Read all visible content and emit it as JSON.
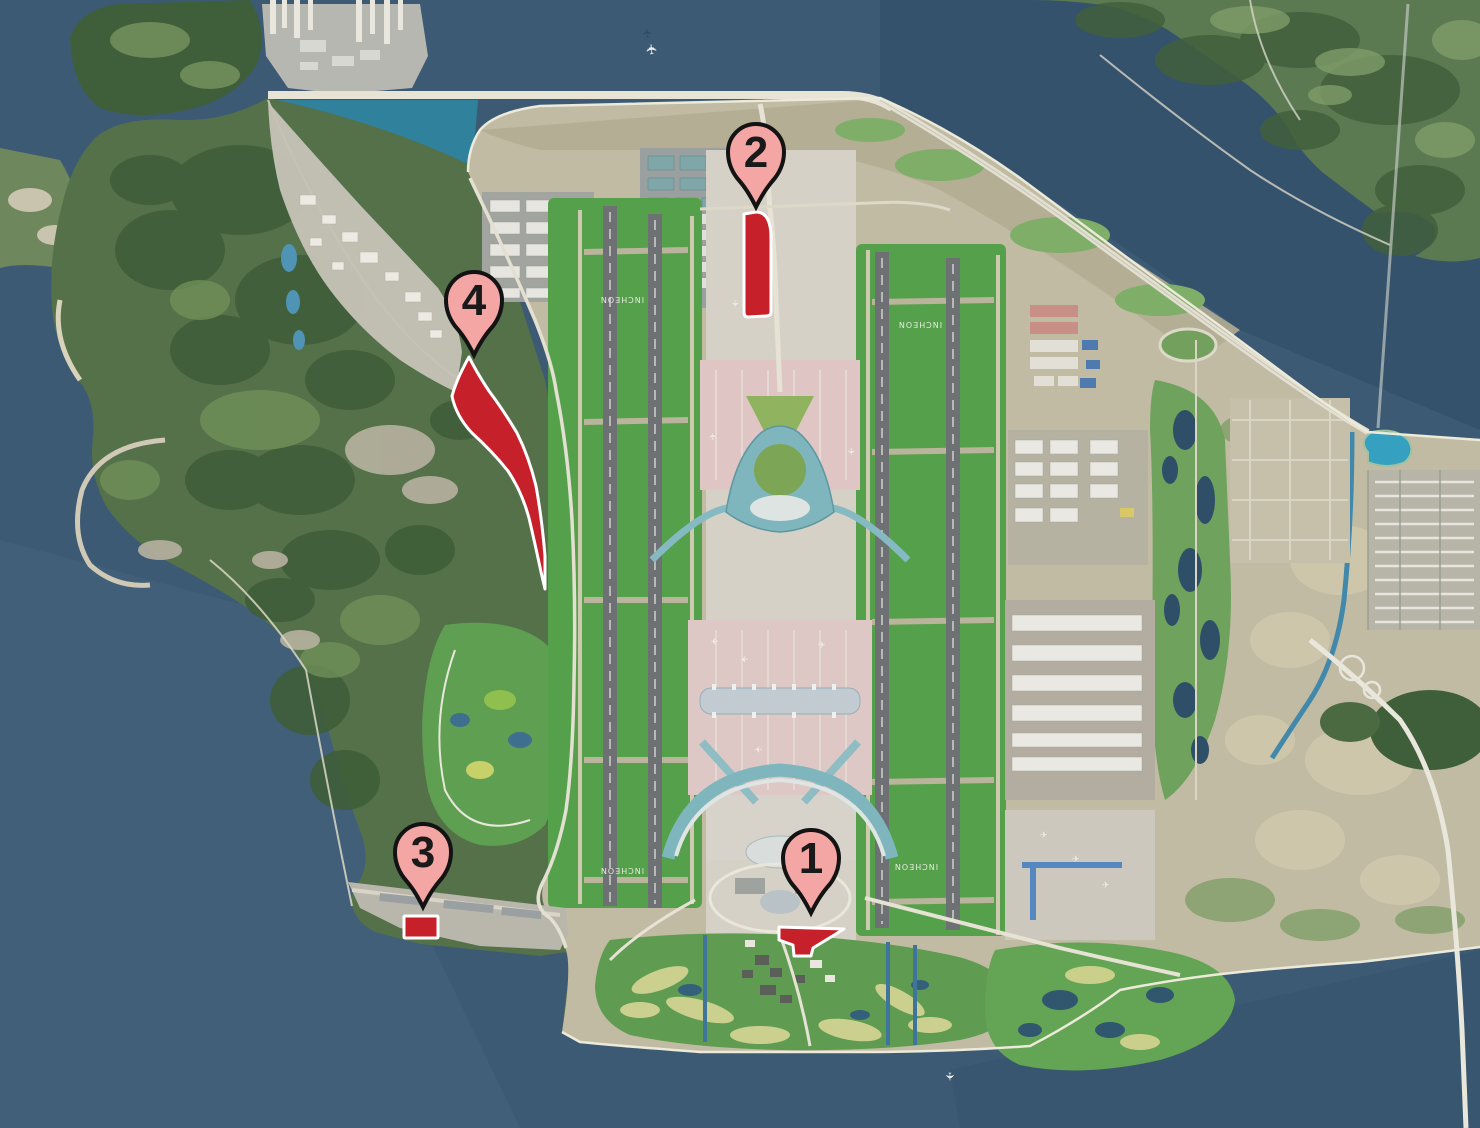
{
  "map": {
    "pins": [
      {
        "label": "1"
      },
      {
        "label": "2"
      },
      {
        "label": "3"
      },
      {
        "label": "4"
      }
    ],
    "runway_labels": [
      "INCHEON",
      "INCHEON",
      "INCHEON",
      "INCHEON"
    ],
    "colors": {
      "highlight_red": "#c6202a",
      "highlight_outline": "#ffffff",
      "pin_fill": "#f4a6a4",
      "pin_outline": "#131313",
      "pin_number": "#1a1a1a",
      "water_deep": "#3d5a74",
      "bay_teal": "#2f819c",
      "airfield_green": "#55a04b",
      "terminal_teal": "#7fb6bd"
    }
  }
}
